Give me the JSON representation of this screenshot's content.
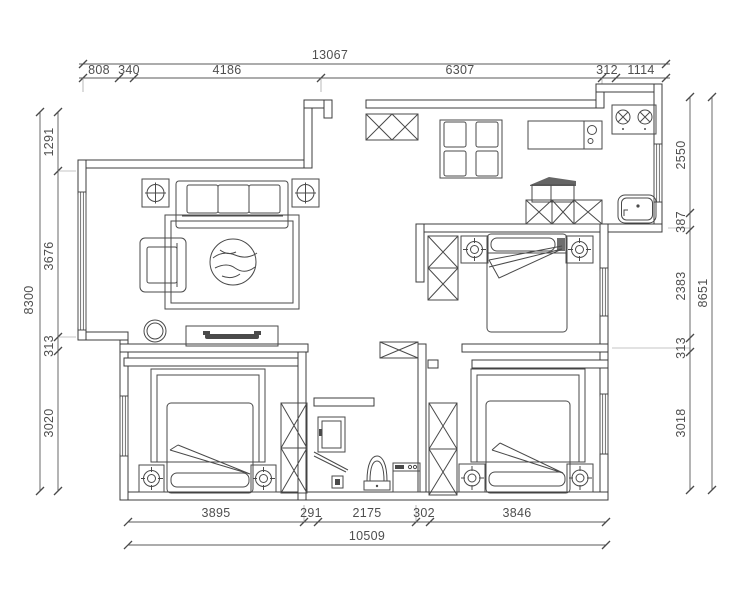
{
  "drawing": {
    "kind": "apartment-floor-plan",
    "units": "mm"
  },
  "colors": {
    "wall_line": "#3c3c3c",
    "furniture_line": "#4a4a4a",
    "dimension_text": "#4f4f4f",
    "background": "#ffffff"
  },
  "dimensions": {
    "top": {
      "overall": "13067",
      "segments": [
        "808",
        "340",
        "4186",
        "6307",
        "312",
        "1114"
      ]
    },
    "left": {
      "overall": "8300",
      "segments": [
        "1291",
        "3676",
        "313",
        "3020"
      ]
    },
    "right": {
      "overall": "8651",
      "segments": [
        "2550",
        "387",
        "2383",
        "313",
        "3018"
      ]
    },
    "bottom": {
      "overall": "10509",
      "segments": [
        "3895",
        "291",
        "2175",
        "302",
        "3846"
      ]
    }
  }
}
